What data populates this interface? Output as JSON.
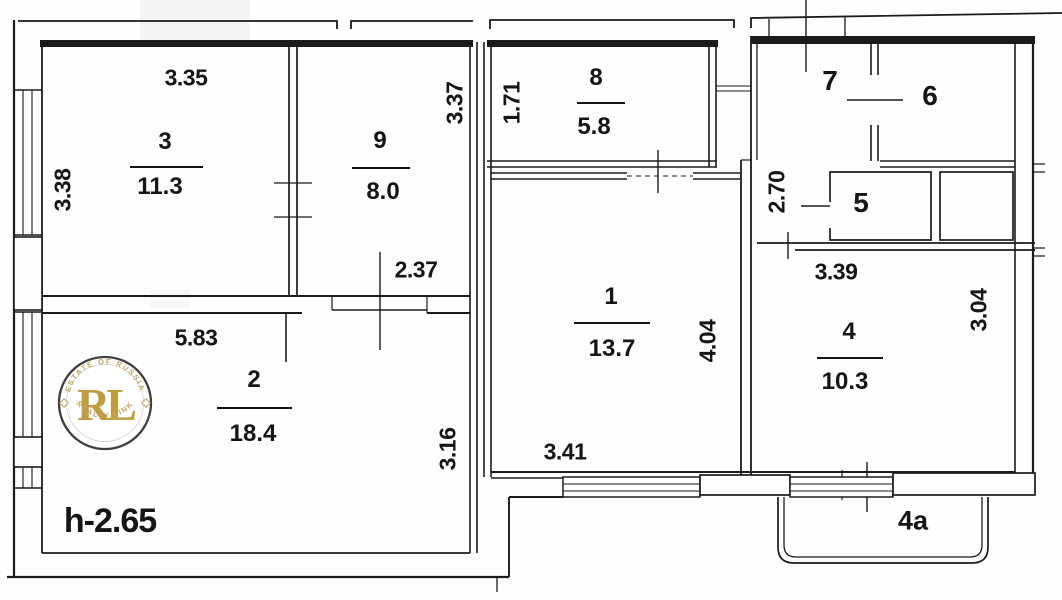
{
  "rooms": [
    {
      "number": "3",
      "area": "11.3"
    },
    {
      "number": "9",
      "area": "8.0"
    },
    {
      "number": "8",
      "area": "5.8"
    },
    {
      "number": "1",
      "area": "13.7"
    },
    {
      "number": "2",
      "area": "18.4"
    },
    {
      "number": "4",
      "area": "10.3"
    },
    {
      "number": "7"
    },
    {
      "number": "6"
    },
    {
      "number": "5"
    }
  ],
  "labels": {
    "balcony": "4a",
    "ceiling_height": "h-2.65"
  },
  "dimensions": {
    "room3_width": "3.35",
    "room3_depth": "3.38",
    "room9_depth": "3.37",
    "room9_width": "2.37",
    "room8_width": "1.71",
    "room2_width": "5.83",
    "room2_depth": "3.16",
    "room1_width": "3.41",
    "room1_depth": "4.04",
    "room4_width": "3.39",
    "room4_depth": "3.04",
    "hallway_length": "2.70"
  },
  "logo": {
    "monogram": "RL",
    "arc_top": "ESTATE OF RUSSIA",
    "arc_bottom": "REALTY LINK"
  },
  "colors": {
    "ink": "#1b1b1b",
    "paper": "#ffffff",
    "logo_gold": "#c09c40",
    "logo_ring": "#3f3f3f"
  }
}
